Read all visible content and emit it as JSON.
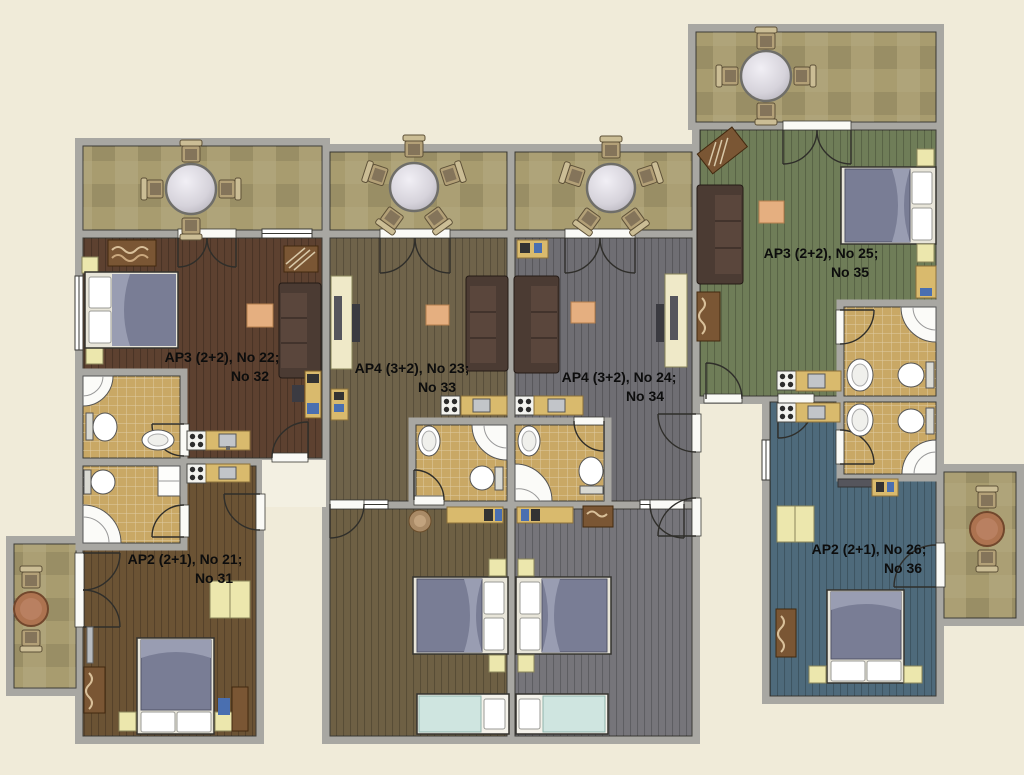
{
  "plan_title": "Apartment floor plan",
  "colors": {
    "background": "#f0ebd9",
    "wall": "#a8a7a2",
    "wall_edge": "#3c3b36",
    "balcony_tile": "#a89c6f",
    "bath_tile": "#c9a865",
    "porch": "#f3f0e2",
    "floor_ap22": "#5d4130",
    "floor_ap23": "#6f634a",
    "floor_ap24": "#6f6e73",
    "floor_ap25": "#6f7d58",
    "floor_ap21": "#6b5334",
    "floor_ap26": "#4e6a7b",
    "floor_bedroom_left": "#6e6044",
    "floor_bedroom_right": "#76757a",
    "bed_blanket": "#797d95",
    "single_bed_blanket": "#cfe5e0",
    "sofa": "#4b3b33",
    "coffee_table": "#e5af80",
    "furniture_yellow": "#ece7ad",
    "counter": "#d9ba6d",
    "wood_furniture": "#7a5634"
  },
  "apartments": [
    {
      "id": "ap22",
      "label_line1": "AP3 (2+2), No 22;",
      "label_line2": "No 32"
    },
    {
      "id": "ap23",
      "label_line1": "AP4 (3+2), No 23;",
      "label_line2": "No 33"
    },
    {
      "id": "ap24",
      "label_line1": "AP4 (3+2), No 24;",
      "label_line2": "No 34"
    },
    {
      "id": "ap25",
      "label_line1": "AP3 (2+2), No 25;",
      "label_line2": "No 35"
    },
    {
      "id": "ap21",
      "label_line1": "AP2 (2+1), No 21;",
      "label_line2": "No 31"
    },
    {
      "id": "ap26",
      "label_line1": "AP2 (2+1), No 26;",
      "label_line2": "No 36"
    }
  ]
}
